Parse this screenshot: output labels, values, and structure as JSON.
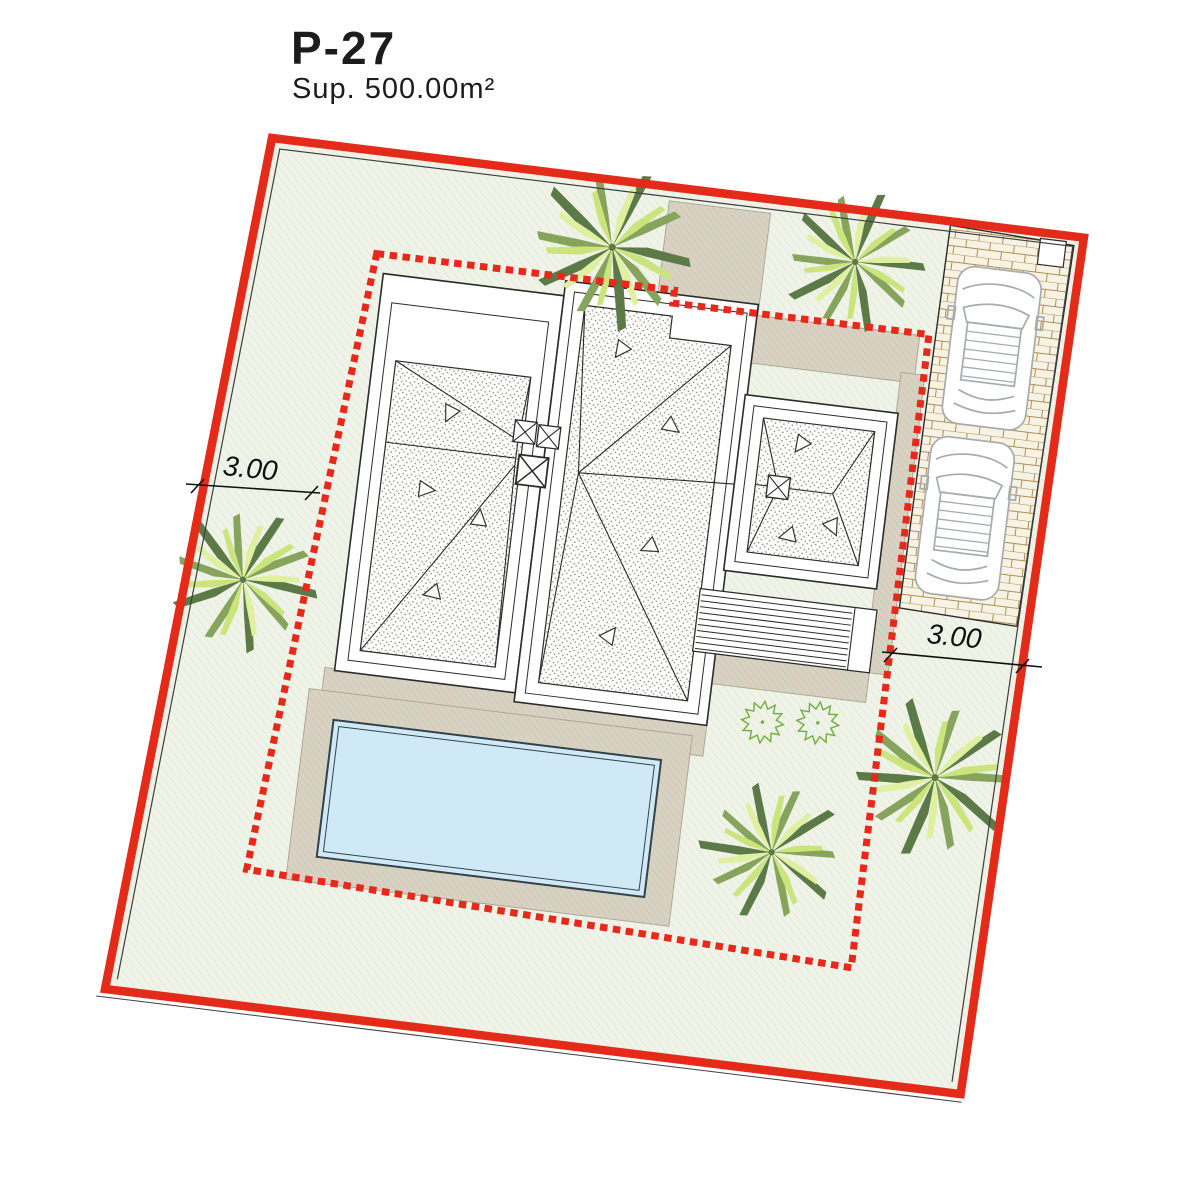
{
  "title": {
    "plot_id": "P-27",
    "area_label": "Sup. 500.00m²"
  },
  "dimensions": {
    "setback_left": "3.00",
    "setback_right": "3.00"
  },
  "colors": {
    "boundary_red": "#e42b1a",
    "setback_dash_red": "#e8281b",
    "lawn_fill": "#eff3e8",
    "lawn_hatch": "#dde7d0",
    "terrace_fill": "#d8d2c3",
    "terrace_hatch": "#c6beac",
    "pool_water": "#cfe9f7",
    "paver_fill": "#f7f3e4",
    "paver_line": "#b08e52",
    "roof_fill": "#fdfdfb",
    "roof_dot": "#767676",
    "line_dark": "#2b2b2b",
    "car_outline": "#a7abae",
    "palm_dark": "#5c7a47",
    "palm_mid": "#86a45c",
    "palm_light": "#cbe57c",
    "shrub_green": "#6fae3f"
  }
}
